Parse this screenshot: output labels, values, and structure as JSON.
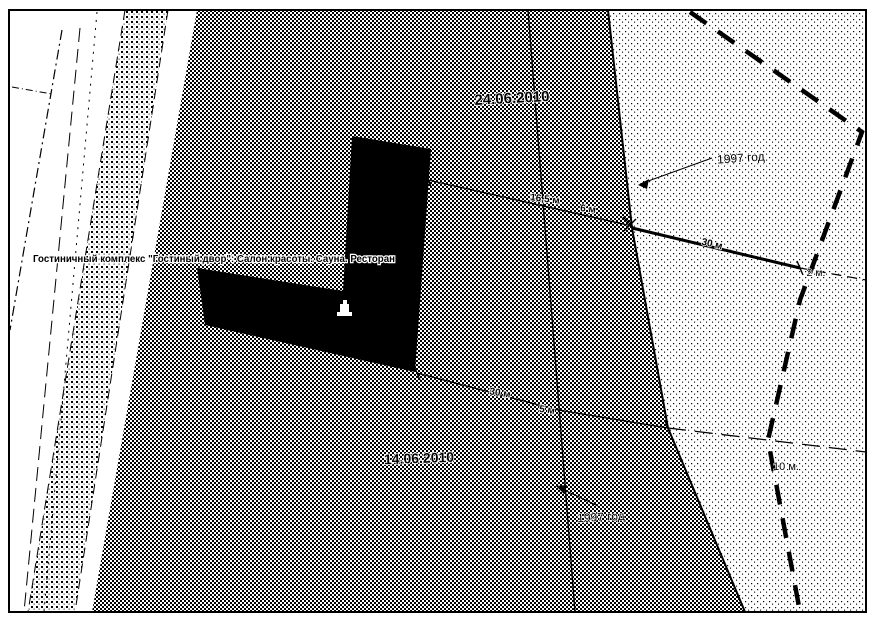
{
  "page": {
    "paper_color": "#ffffff",
    "ink_color": "#000000"
  },
  "map": {
    "building_label": "Гостиничный комплекс \"Гостиный двор\": Салон красоты. Сауна. Ресторан",
    "dates": {
      "survey_top": "24.06.2010",
      "survey_bottom": "14.06.2010"
    },
    "years": {
      "top": "1997 год",
      "bottom": "1997 год"
    },
    "dimensions": {
      "d1": "16,5 м",
      "d2": "6 м",
      "d3": "30 м",
      "d4": "5 м",
      "d5": "30 м",
      "d6": "2 м.",
      "d7": "10 м."
    },
    "icons": {
      "building": "building-icon"
    }
  }
}
